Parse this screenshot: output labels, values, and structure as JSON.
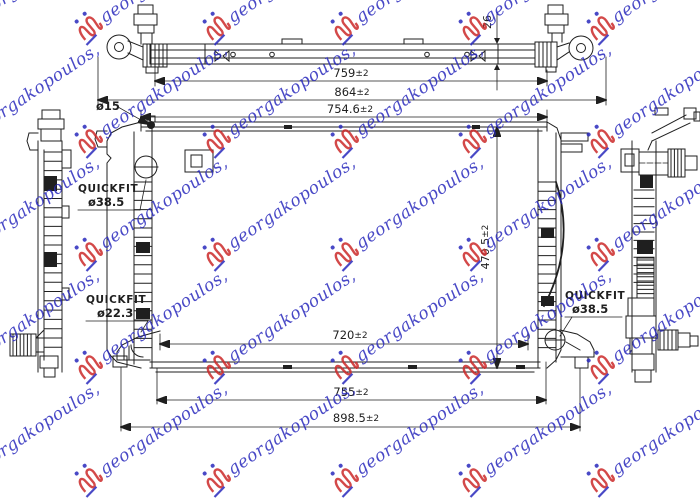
{
  "watermark": {
    "text": "georgakopoulos,",
    "text_color": "#2a2abd",
    "logo_color": "#cc2a2a"
  },
  "drawing": {
    "line_color": "#1f1f1f",
    "dimensions": {
      "top_bar_length": {
        "value": "759",
        "tolerance": "±2"
      },
      "overall_top_width": {
        "value": "864",
        "tolerance": "±2"
      },
      "core_top_width": {
        "value": "754.6",
        "tolerance": "±2"
      },
      "core_bottom_width": {
        "value": "720",
        "tolerance": "±2"
      },
      "bottom_width": {
        "value": "755",
        "tolerance": "±2"
      },
      "overall_bottom_width": {
        "value": "898.5",
        "tolerance": "±2"
      },
      "core_height": {
        "value": "470.5",
        "tolerance": "±2"
      },
      "core_depth": {
        "value": "26"
      },
      "pipe_diameter": {
        "value": "ø15"
      }
    },
    "callouts": {
      "left_upper": {
        "title": "QUICKFIT",
        "diameter": "ø38.5"
      },
      "left_lower": {
        "title": "QUICKFIT",
        "diameter": "ø22.3"
      },
      "right_lower": {
        "title": "QUICKFIT",
        "diameter": "ø38.5"
      }
    }
  }
}
